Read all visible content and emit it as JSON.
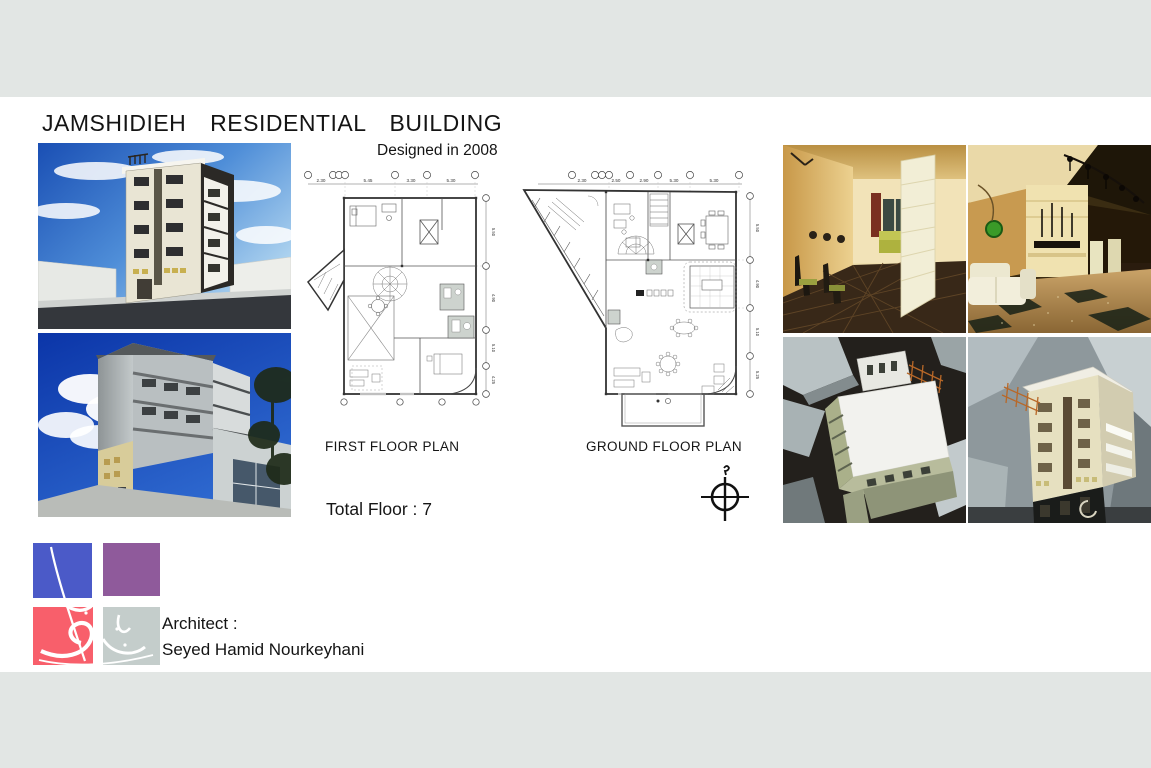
{
  "header": {
    "title": "JAMSHIDIEH RESIDENTIAL BUILDING",
    "subtitle": "Designed in 2008"
  },
  "plans": {
    "first": {
      "label": "FIRST FLOOR PLAN",
      "top_dims": [
        "2.30",
        "5.45",
        "3.30",
        "5.30"
      ],
      "side_dims": [
        "5.50",
        "4.90",
        "5.10",
        "4.25"
      ]
    },
    "ground": {
      "label": "GROUND FLOOR PLAN",
      "top_dims": [
        "2.30",
        "2.50",
        "2.90",
        "5.30",
        "5.30"
      ],
      "side_dims": [
        "5.50",
        "4.90",
        "5.10",
        "5.25"
      ]
    },
    "total_floor": "Total Floor : 7"
  },
  "architect": {
    "label": "Architect :",
    "name": "Seyed Hamid Nourkeyhani"
  },
  "icons": {
    "north_compass": "crosshair-circle-with-north-mark"
  },
  "colors": {
    "band_gray": "#e2e6e4",
    "logo_blue": "#4b5ac8",
    "logo_purple": "#8f5a9b",
    "logo_red": "#f85f6b",
    "logo_gray": "#c4cdcb"
  }
}
